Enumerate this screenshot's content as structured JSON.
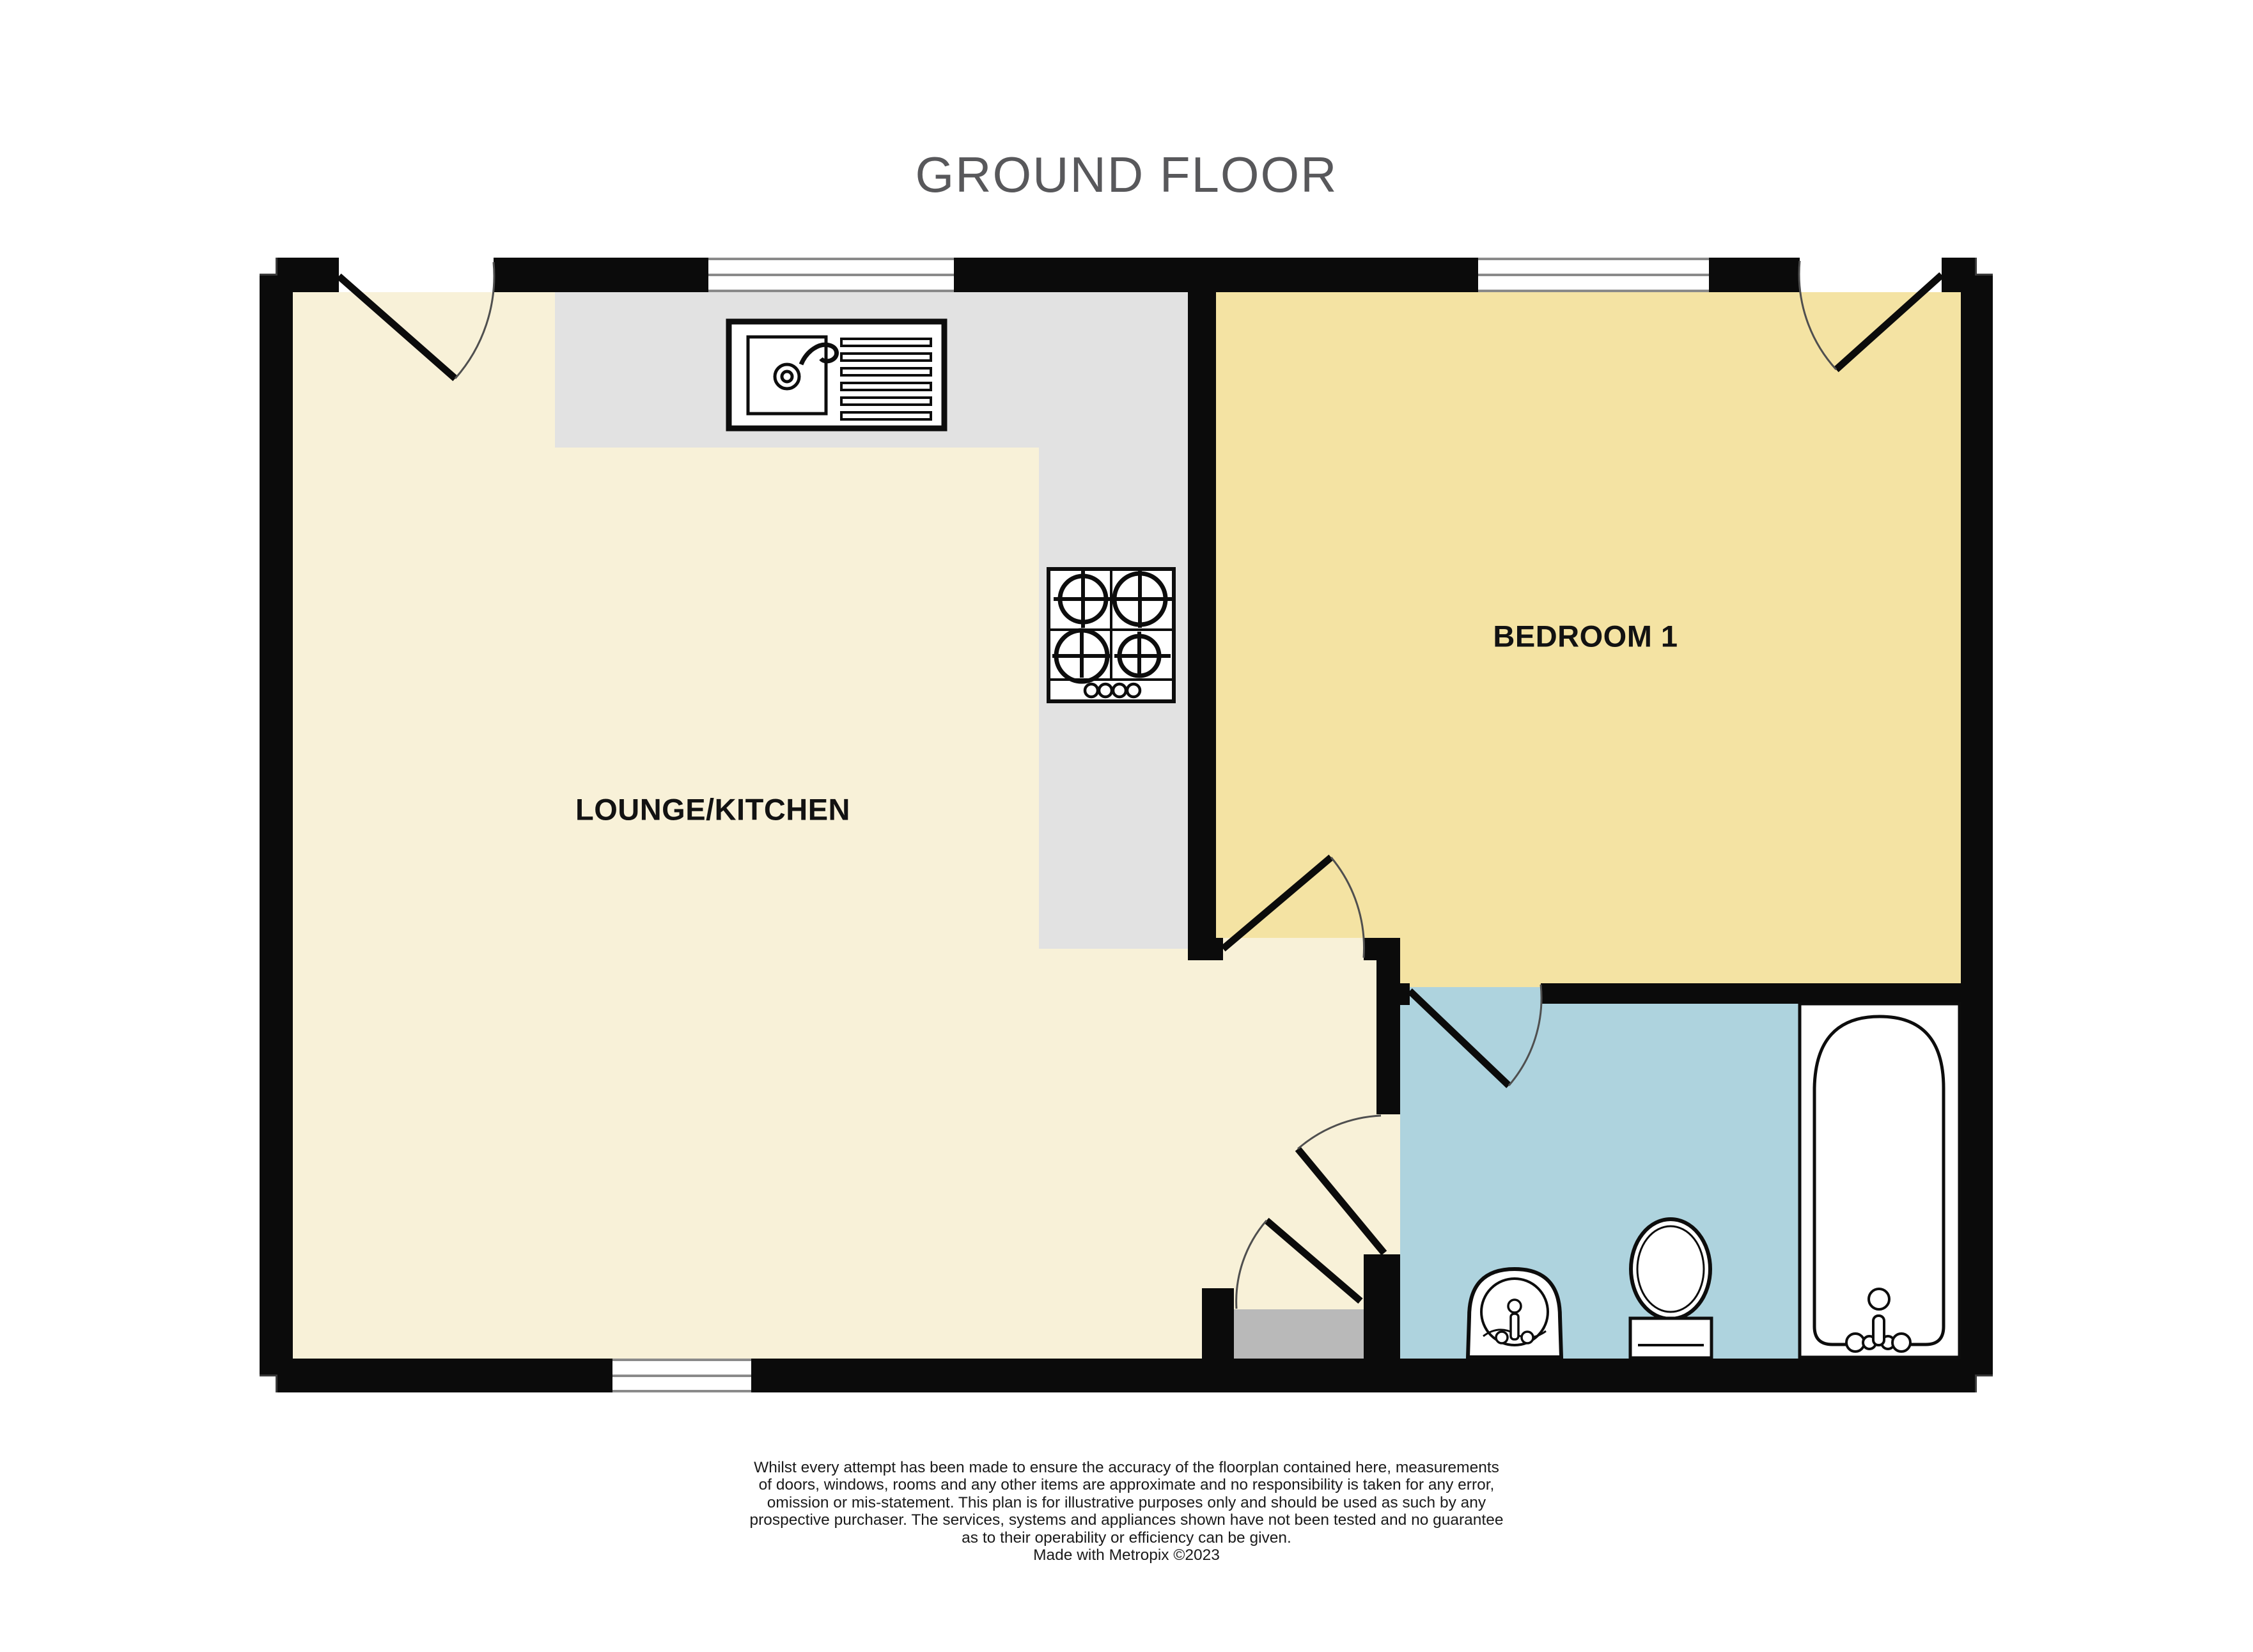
{
  "title": "GROUND FLOOR",
  "rooms": {
    "lounge_kitchen": {
      "label": "LOUNGE/KITCHEN"
    },
    "bedroom_1": {
      "label": "BEDROOM 1"
    },
    "bathroom": {
      "label": ""
    }
  },
  "fixtures": [
    "sink-with-drainer",
    "hob-4-burners",
    "bath",
    "toilet",
    "basin"
  ],
  "footer": {
    "disclaimer_lines": [
      "Whilst every attempt has been made to ensure the accuracy of the floorplan contained here, measurements",
      "of doors, windows, rooms and any other items are approximate and no responsibility is taken for any error,",
      "omission or mis-statement. This plan is for illustrative purposes only and should be used as such by any",
      "prospective purchaser. The services, systems and appliances shown have not been tested and no guarantee",
      "as to their operability or efficiency can be given."
    ],
    "credit": "Made with Metropix ©2023"
  },
  "colors": {
    "wall": "#0B0B0B",
    "lounge_floor": "#F8F1D8",
    "bedroom_floor": "#F4E3A3",
    "bathroom_floor": "#AED3DE",
    "counter": "#E2E2E2",
    "step": "#B9B9B9",
    "window_line": "#8A8A8A",
    "title_text": "#58585B",
    "label_text": "#121212",
    "disclaimer_text": "#1A1A1A",
    "fixture_stroke": "#0D0D0D",
    "door_arc": "#4F4F4F"
  }
}
